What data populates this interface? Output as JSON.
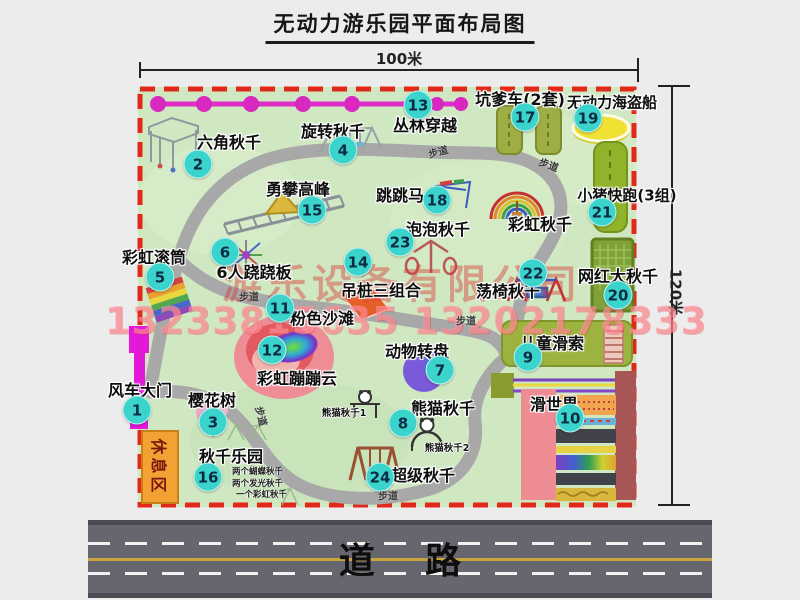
{
  "title": "无动力游乐园平面布局图",
  "dimension_top": "100米",
  "dimension_right": "120米",
  "road": {
    "label": "道    路"
  },
  "watermark": {
    "company": "游乐设备有限公司",
    "phone": "13233815635 13202178333"
  },
  "rest_area": {
    "label": "休息区"
  },
  "trail": {
    "label": "步道",
    "positions": [
      [
        438,
        151,
        -15
      ],
      [
        549,
        164,
        20
      ],
      [
        249,
        296,
        0
      ],
      [
        262,
        416,
        75
      ],
      [
        388,
        495,
        0
      ],
      [
        466,
        320,
        0
      ]
    ]
  },
  "attractions": [
    {
      "num": 1,
      "name": "风车大门",
      "b": [
        137,
        410
      ],
      "l": [
        140,
        389
      ]
    },
    {
      "num": 2,
      "name": "六角秋千",
      "b": [
        198,
        164
      ],
      "l": [
        229,
        141
      ]
    },
    {
      "num": 3,
      "name": "樱花树",
      "b": [
        213,
        422
      ],
      "l": [
        212,
        399
      ]
    },
    {
      "num": 4,
      "name": "旋转秋千",
      "b": [
        343,
        150
      ],
      "l": [
        333,
        130
      ]
    },
    {
      "num": 5,
      "name": "彩虹滚筒",
      "b": [
        160,
        277
      ],
      "l": [
        154,
        256
      ]
    },
    {
      "num": 6,
      "name": "6人跷跷板",
      "b": [
        225,
        252
      ],
      "l": [
        254,
        271
      ]
    },
    {
      "num": 7,
      "name": "动物转盘",
      "b": [
        440,
        370
      ],
      "l": [
        417,
        350
      ]
    },
    {
      "num": 8,
      "name": "熊猫秋千",
      "b": [
        403,
        423
      ],
      "l": [
        443,
        407
      ]
    },
    {
      "num": 9,
      "name": "儿童滑索",
      "b": [
        528,
        357
      ],
      "l": [
        552,
        342
      ]
    },
    {
      "num": 10,
      "name": "滑世界",
      "b": [
        570,
        418
      ],
      "l": [
        554,
        403
      ]
    },
    {
      "num": 11,
      "name": "粉色沙滩",
      "b": [
        280,
        308
      ],
      "l": [
        322,
        317
      ]
    },
    {
      "num": 12,
      "name": "彩虹蹦蹦云",
      "b": [
        272,
        350
      ],
      "l": [
        297,
        377
      ]
    },
    {
      "num": 13,
      "name": "丛林穿越",
      "b": [
        418,
        105
      ],
      "l": [
        425,
        124
      ]
    },
    {
      "num": 14,
      "name": "吊桩三组合",
      "b": [
        358,
        262
      ],
      "l": [
        381,
        289
      ]
    },
    {
      "num": 15,
      "name": "勇攀高峰",
      "b": [
        312,
        210
      ],
      "l": [
        298,
        188
      ]
    },
    {
      "num": 16,
      "name": "秋千乐园",
      "b": [
        208,
        477
      ],
      "l": [
        231,
        455
      ],
      "notes": [
        "两个蝴蝶秋千",
        "两个发光秋千",
        "一个彩虹秋千"
      ],
      "notes_x": 232,
      "notes_y": 471
    },
    {
      "num": 17,
      "name": "坑爹车(2套)",
      "b": [
        525,
        117
      ],
      "l": [
        520,
        98
      ]
    },
    {
      "num": 18,
      "name": "跳跳马",
      "b": [
        437,
        200
      ],
      "l": [
        400,
        194
      ]
    },
    {
      "num": 19,
      "name": "无动力海盗船",
      "b": [
        588,
        118
      ],
      "l": [
        612,
        102
      ],
      "size": 15
    },
    {
      "num": 20,
      "name": "网红大秋千",
      "b": [
        618,
        295
      ],
      "l": [
        618,
        275
      ]
    },
    {
      "num": 21,
      "name": "小猪快跑(3组)",
      "b": [
        602,
        212
      ],
      "l": [
        627,
        195
      ],
      "size": 15
    },
    {
      "num": 22,
      "name": "荡椅秋千",
      "b": [
        533,
        273
      ],
      "l": [
        508,
        290
      ]
    },
    {
      "num": 23,
      "name": "泡泡秋千",
      "b": [
        400,
        242
      ],
      "l": [
        438,
        228
      ]
    },
    {
      "num": 24,
      "name": "超级秋千",
      "b": [
        380,
        477
      ],
      "l": [
        423,
        474
      ]
    }
  ],
  "extra_labels": [
    {
      "text": "彩虹秋千",
      "x": 540,
      "y": 223,
      "size": 16
    },
    {
      "text": "熊猫秋千1",
      "x": 344,
      "y": 412,
      "size": 9.5
    },
    {
      "text": "熊猫秋千2",
      "x": 447,
      "y": 447,
      "size": 9.5
    }
  ],
  "colors": {
    "map_bg": "#cfe8c2",
    "border_red": "#e22818",
    "badge": "#3bd4cc",
    "path_gray": "#a8a8a8",
    "zipline_magenta": "#e02cc8",
    "rest_orange": "#f2a232",
    "road_gray": "#66666e",
    "road_yellow": "#c9a43c"
  }
}
